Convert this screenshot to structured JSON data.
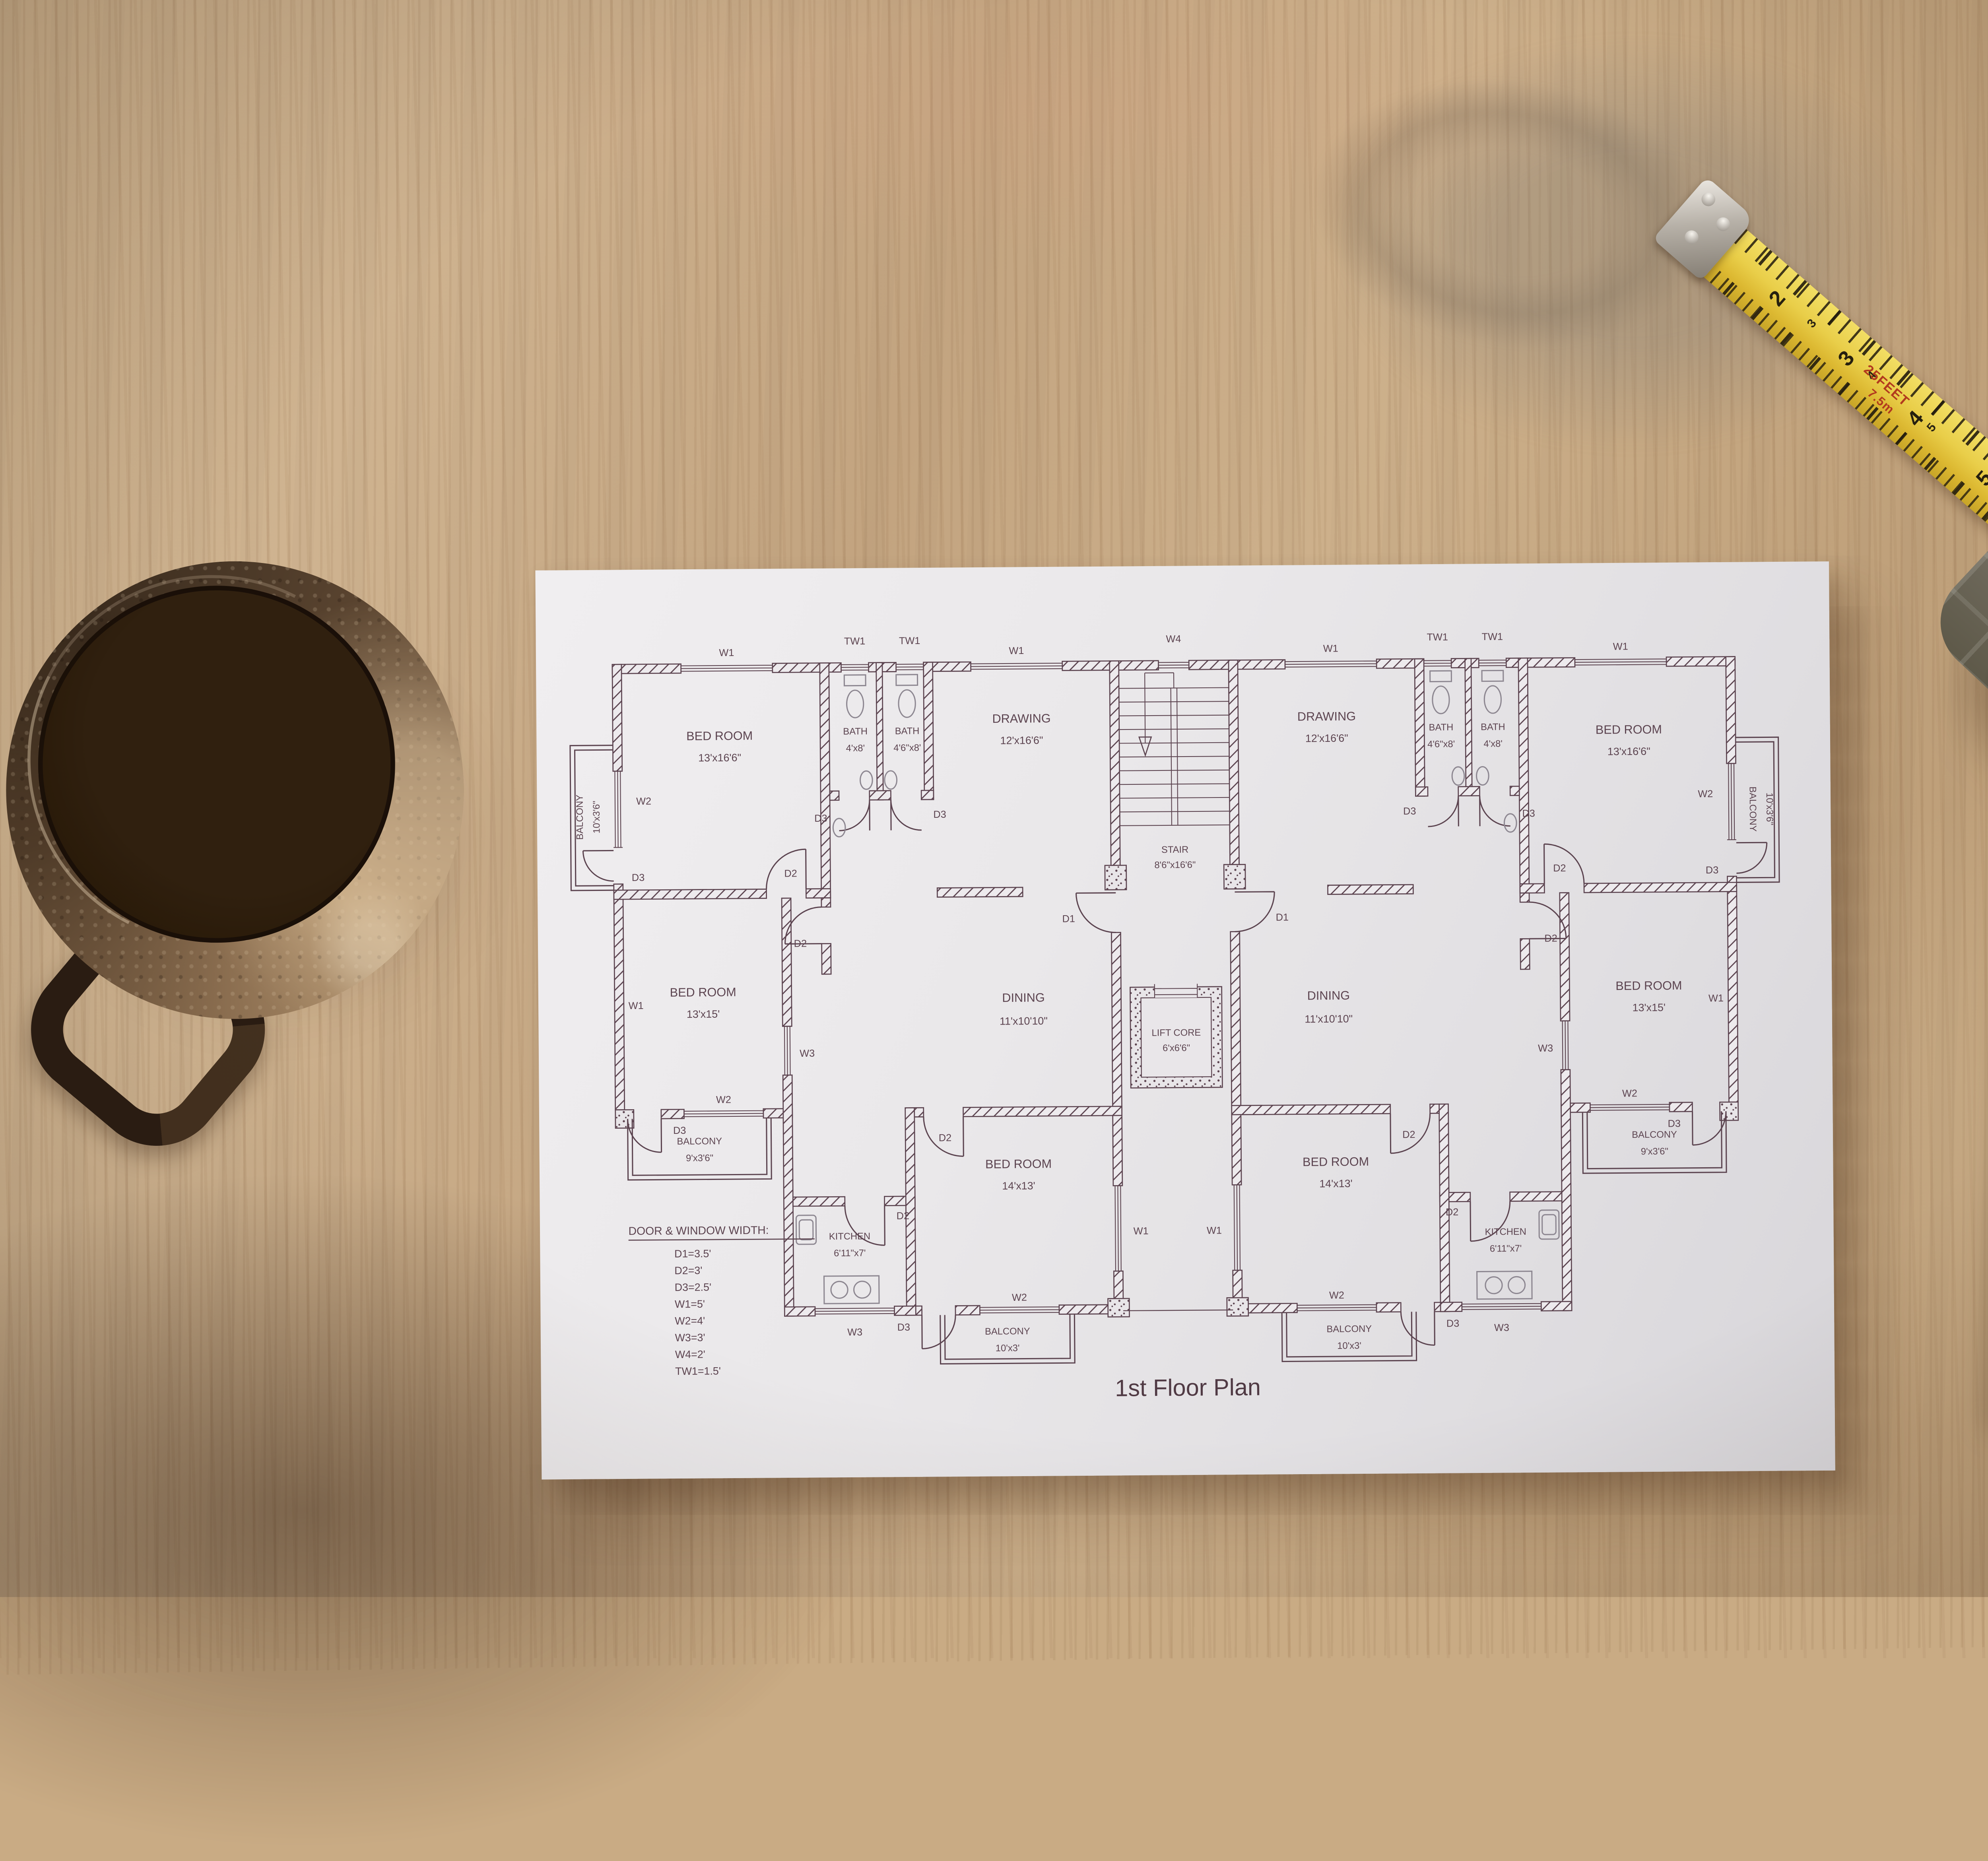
{
  "plan": {
    "title": "1st Floor Plan",
    "legend_title": "DOOR & WINDOW WIDTH:",
    "legend_items": [
      "D1=3.5'",
      "D2=3'",
      "D3=2.5'",
      "W1=5'",
      "W2=4'",
      "W3=3'",
      "W4=2'",
      "TW1=1.5'"
    ],
    "rooms": {
      "bedroom_large": {
        "name": "BED ROOM",
        "dims": "13'x16'6\""
      },
      "bedroom_mid": {
        "name": "BED ROOM",
        "dims": "13'x15'"
      },
      "bedroom_bottom": {
        "name": "BED ROOM",
        "dims": "14'x13'"
      },
      "drawing": {
        "name": "DRAWING",
        "dims": "12'x16'6\""
      },
      "dining": {
        "name": "DINING",
        "dims": "11'x10'10\""
      },
      "stair": {
        "name": "STAIR",
        "dims": "8'6\"x16'6\""
      },
      "lift": {
        "name": "LIFT CORE",
        "dims": "6'x6'6\""
      },
      "kitchen": {
        "name": "KITCHEN",
        "dims": "6'11\"x7'"
      },
      "bath_a": {
        "name": "BATH",
        "dims": "4'x8'"
      },
      "bath_b": {
        "name": "BATH",
        "dims": "4'6\"x8'"
      },
      "balcony_top": {
        "name": "BALCONY",
        "dims": "10'x3'6\""
      },
      "balcony_mid": {
        "name": "BALCONY",
        "dims": "9'x3'6\""
      },
      "balcony_bottom": {
        "name": "BALCONY",
        "dims": "10'x3'"
      }
    },
    "markers": {
      "d1": "D1",
      "d2": "D2",
      "d3": "D3",
      "w1": "W1",
      "w2": "W2",
      "w3": "W3",
      "w4": "W4",
      "tw1": "TW1"
    }
  },
  "tape": {
    "feet_label": "25FEET",
    "metric_label": "7.5m",
    "numbers_large": [
      "2",
      "3",
      "4",
      "5"
    ],
    "numbers_small": [
      "3",
      "4",
      "5",
      "6",
      "7"
    ]
  }
}
